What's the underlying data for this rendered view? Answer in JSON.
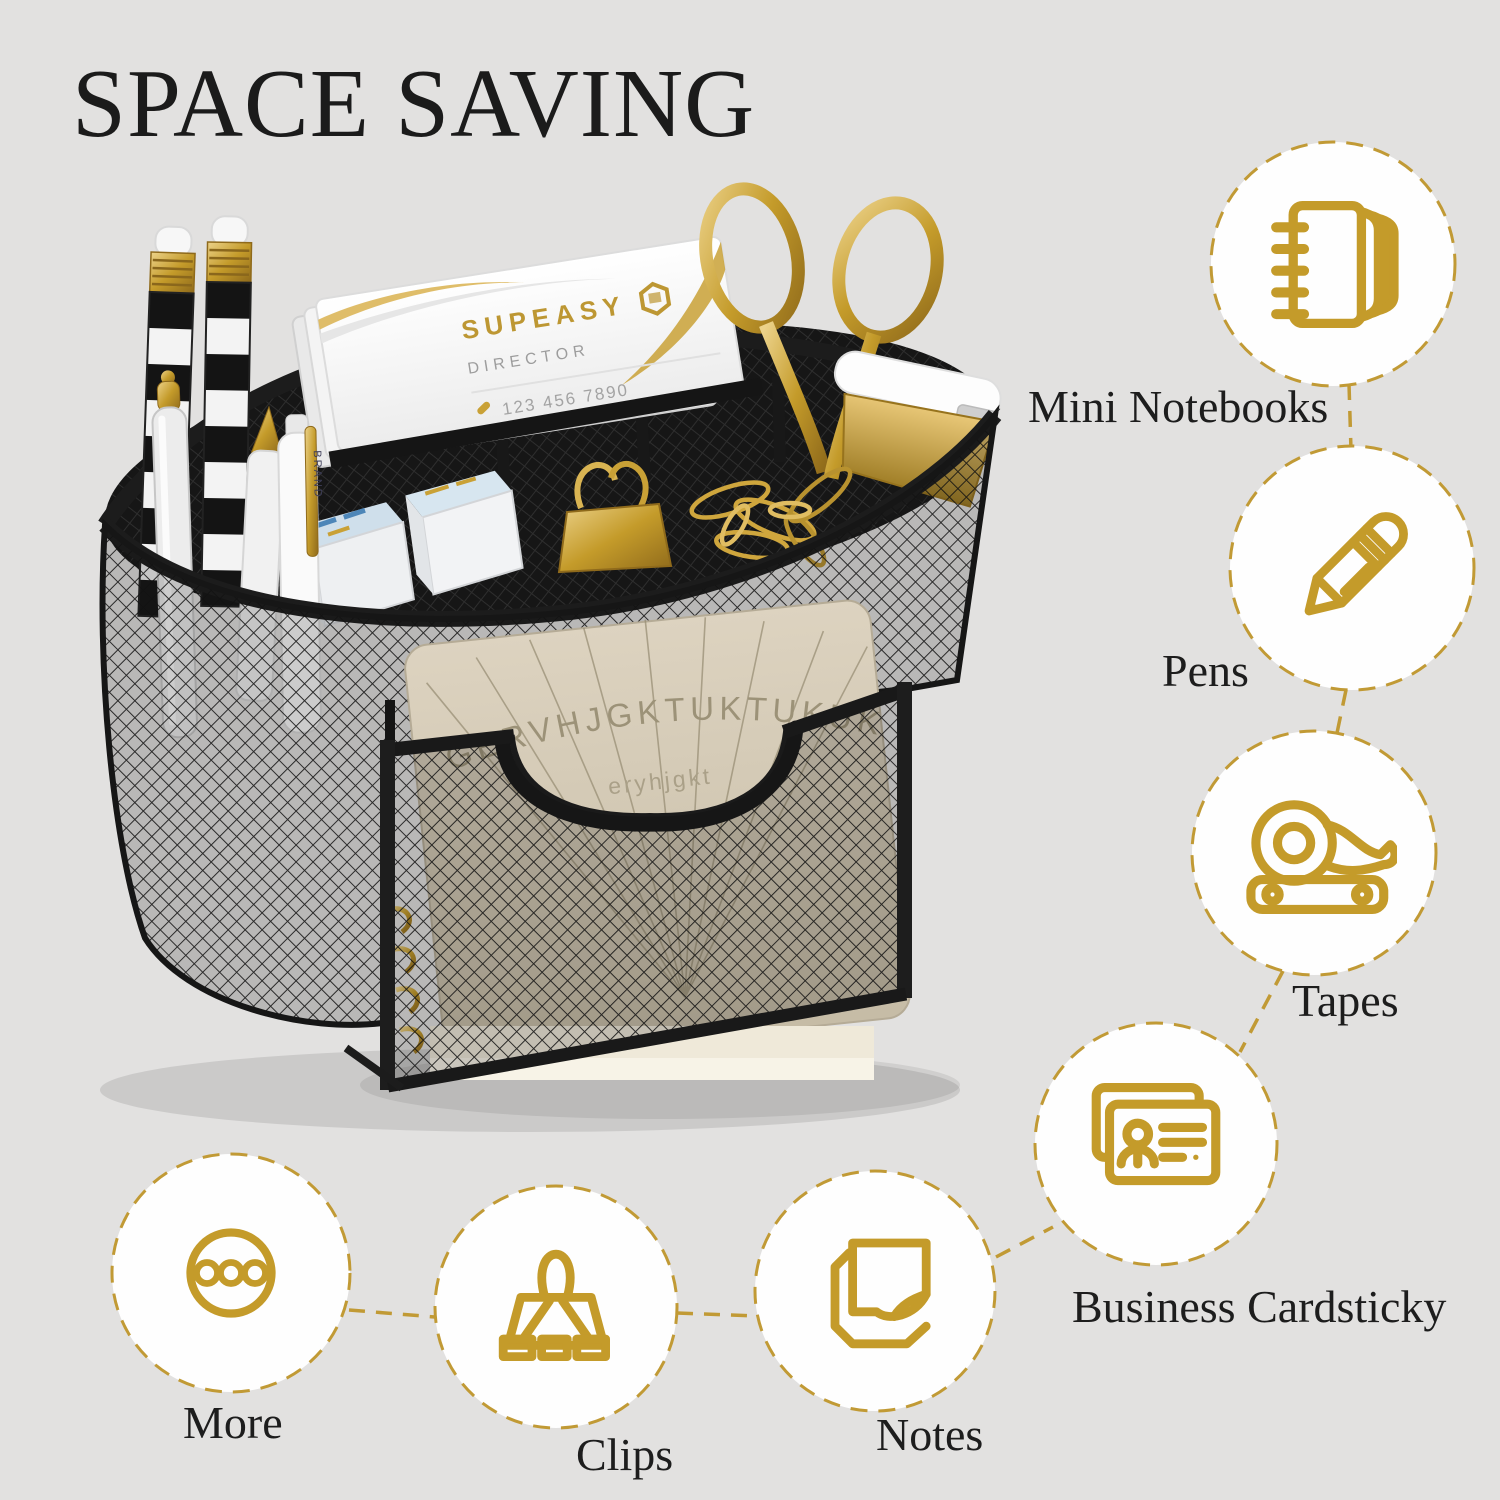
{
  "title": "SPACE SAVING",
  "colors": {
    "background": "#e2e1e0",
    "accent_gold": "#c49b2a",
    "dashed_gold": "#c19a35",
    "text": "#1d1d1d",
    "organizer_black": "#161616",
    "note_beige": "#d2c8b2"
  },
  "features": [
    {
      "id": "mini-notebooks",
      "label": "Mini Notebooks",
      "icon": "notebook-icon"
    },
    {
      "id": "pens",
      "label": "Pens",
      "icon": "pencil-icon"
    },
    {
      "id": "tapes",
      "label": "Tapes",
      "icon": "tape-dispenser-icon"
    },
    {
      "id": "business-cardsticky",
      "label": "Business Cardsticky",
      "icon": "business-cards-icon"
    },
    {
      "id": "more",
      "label": "More",
      "icon": "more-dots-icon"
    },
    {
      "id": "clips",
      "label": "Clips",
      "icon": "binder-clip-icon"
    },
    {
      "id": "notes",
      "label": "Notes",
      "icon": "sticky-notes-icon"
    }
  ],
  "photo": {
    "business_card": {
      "brand": "SUPEASY",
      "role": "DIRECTOR",
      "phone": "123 456 7890"
    },
    "pen_clip": "BRAND",
    "note_sheet": {
      "line1": "GERVHJGKTUKTUKUKK",
      "line2": "eryhjgkt"
    }
  }
}
